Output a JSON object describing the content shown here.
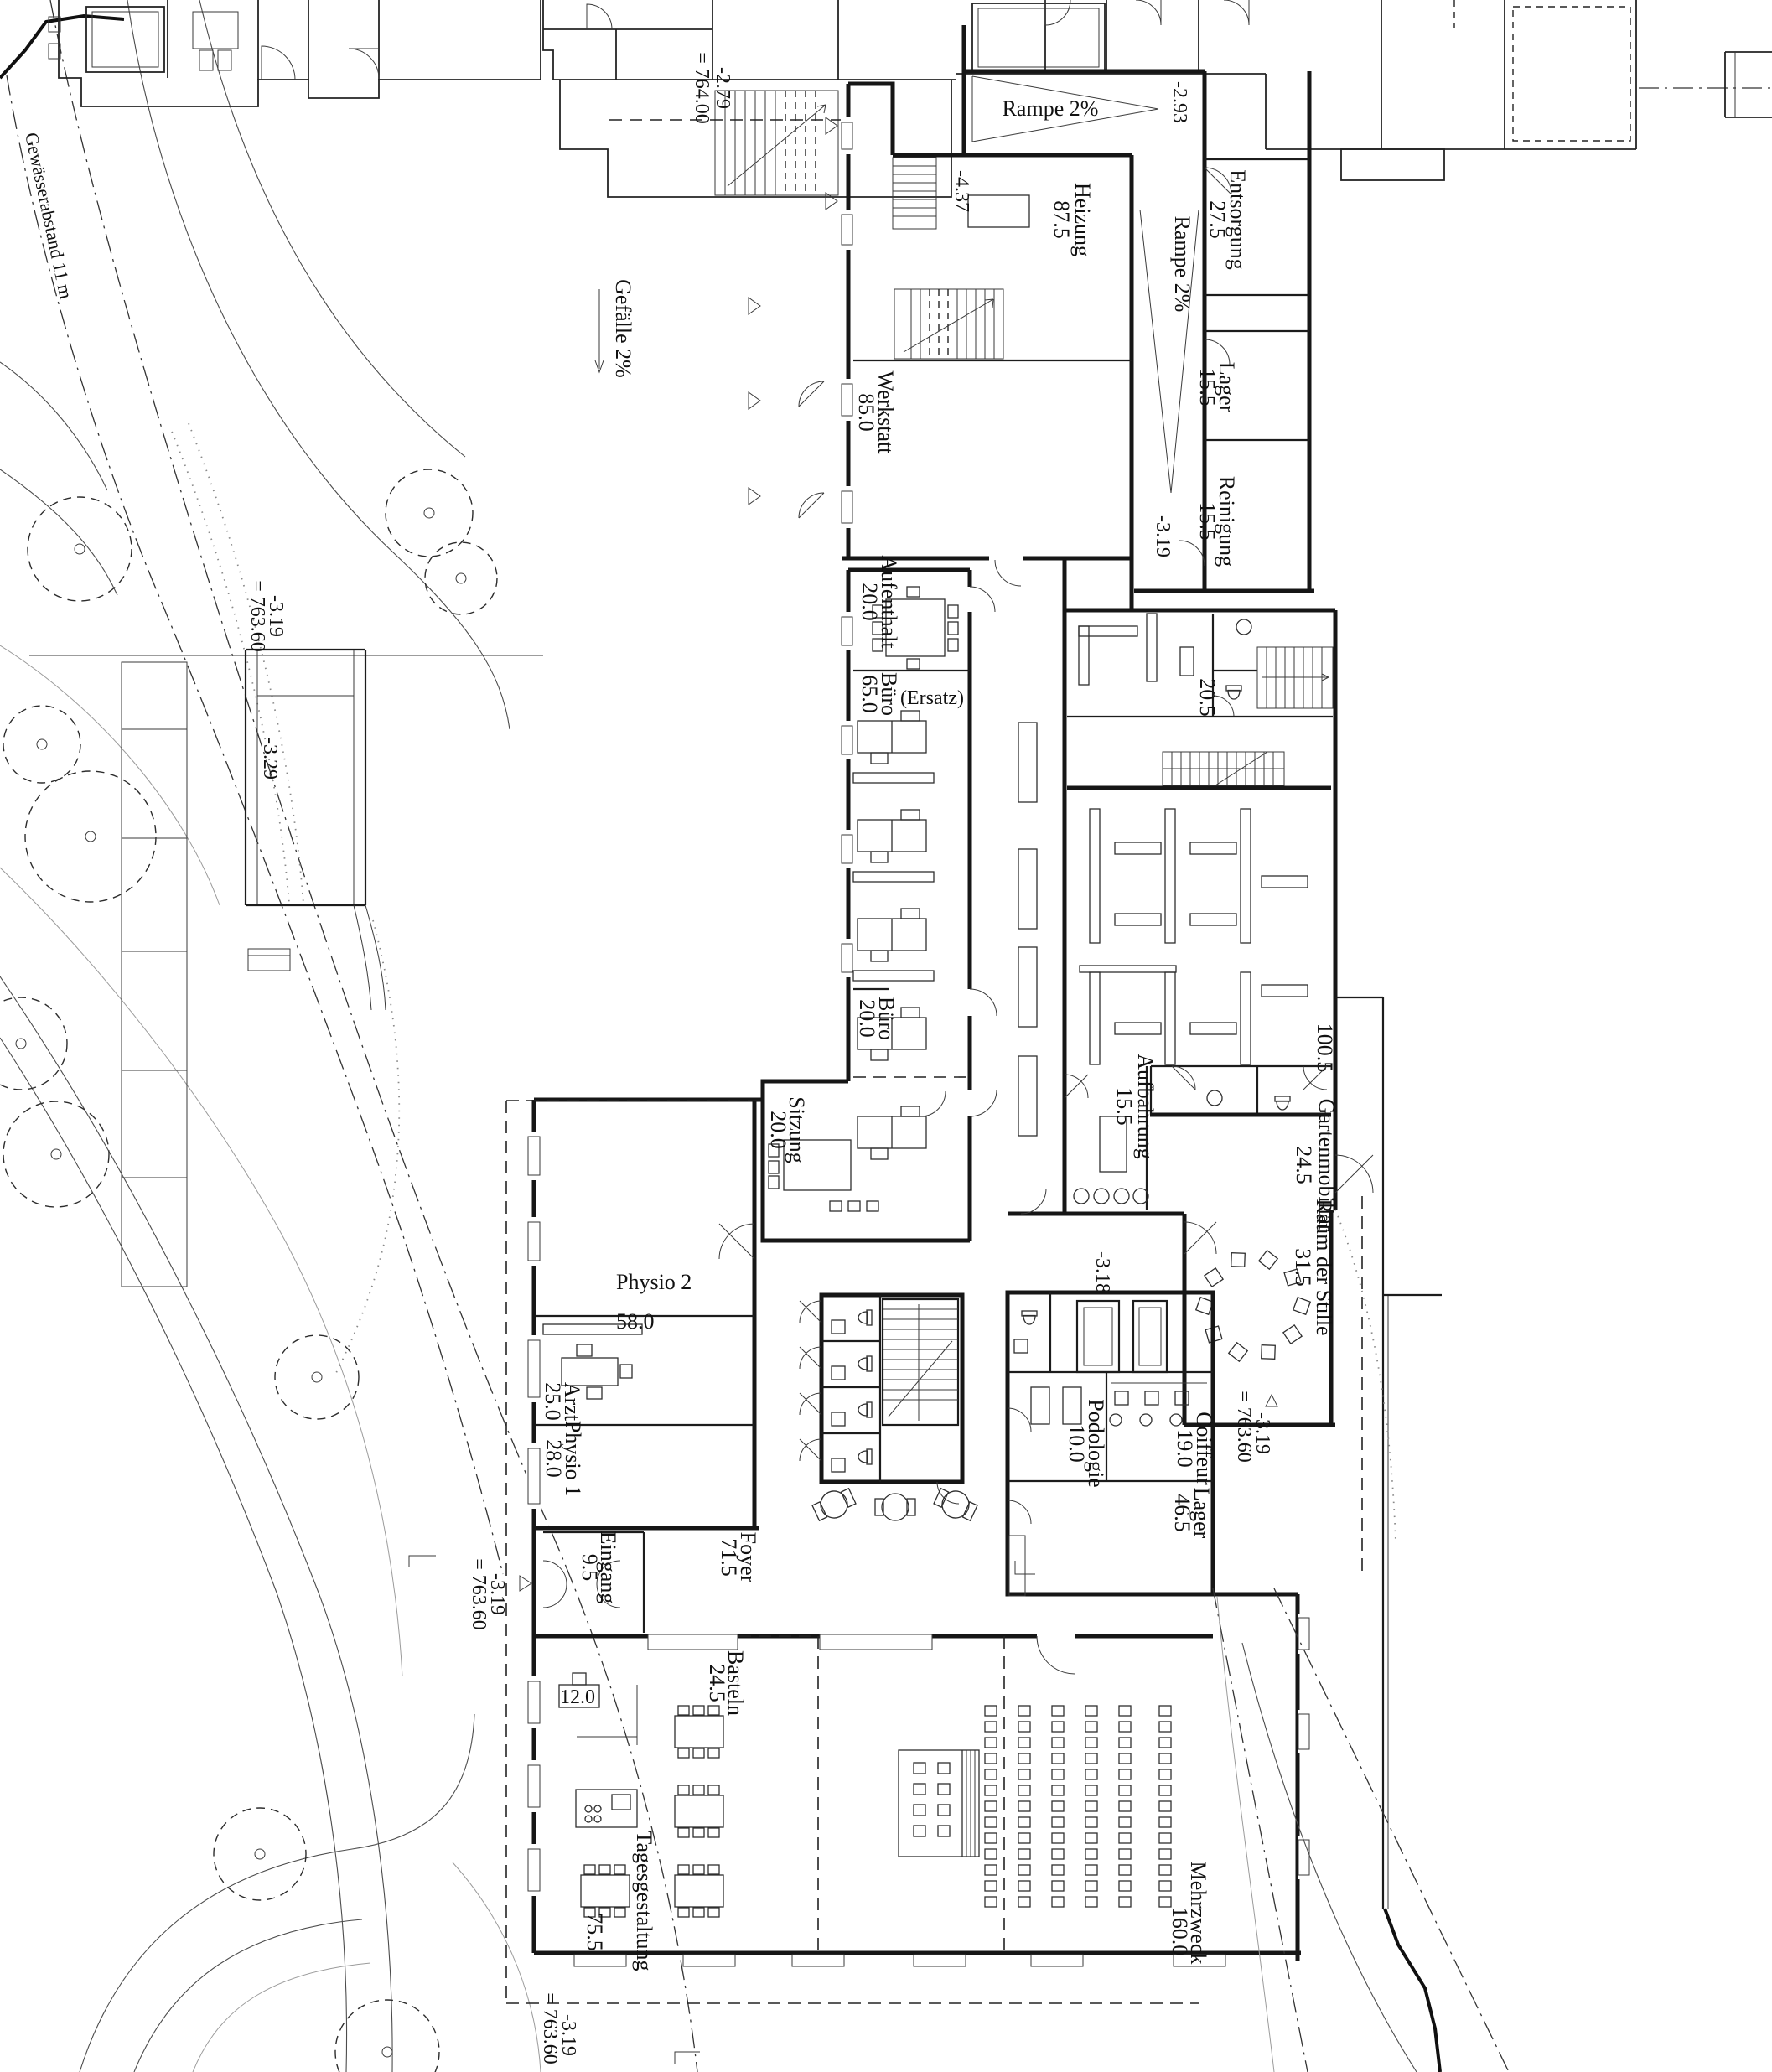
{
  "site": {
    "gewaesserabstand": "Gewässerabstand 11 m",
    "gefaelle": "Gefälle 2%"
  },
  "levels": {
    "l279": "-2.79",
    "l279eq": "= 764.00",
    "l293": "-2.93",
    "l437": "-4.37",
    "l319a": "-3.19",
    "l318": "-3.18",
    "l329": "-3.29",
    "bridge319": "-3.19",
    "bridge319eq": "= 763.60",
    "entr319": "-3.19",
    "entr319eq": "= 763.60",
    "terr319": "-3.19",
    "terr319eq": "= 763.60",
    "bottom319": "-3.19",
    "bottom319eq": "= 763.60"
  },
  "rooms": {
    "rampe_top": "Rampe 2%",
    "rampe_side": "Rampe 2%",
    "heizung": {
      "name": "Heizung",
      "area": "87.5"
    },
    "entsorgung": {
      "name": "Entsorgung",
      "area": "27.5"
    },
    "werkstatt": {
      "name": "Werkstatt",
      "area": "85.0"
    },
    "lager_nord": {
      "name": "Lager",
      "area": "15.5"
    },
    "reinigung": {
      "name": "Reinigung",
      "area": "15.5"
    },
    "aufenthalt": {
      "name": "Aufenthalt",
      "area": "20.0"
    },
    "buero65": {
      "name": "Büro",
      "area": "65.0",
      "note": "(Ersatz)"
    },
    "buero20": {
      "name": "Büro",
      "area": "20.0"
    },
    "raum205": {
      "area": "20.5"
    },
    "lager1005": {
      "area": "100.5"
    },
    "sitzung": {
      "name": "Sitzung",
      "area": "20.0"
    },
    "aufbahrung": {
      "name": "Aufbahrung",
      "area": "15.5"
    },
    "gartenmobiliar": {
      "name": "Gartenmobiliar",
      "area": "24.5"
    },
    "raum_der_stille": {
      "name": "Raum der Stille",
      "area": "31.5"
    },
    "physio2": {
      "name": "Physio 2",
      "area": "58.0"
    },
    "arzt": {
      "name": "Arzt",
      "area": "25.0"
    },
    "physio1": {
      "name": "Physio 1",
      "area": "28.0"
    },
    "eingang": {
      "name": "Eingang",
      "area": "9.5"
    },
    "foyer": {
      "name": "Foyer",
      "area": "71.5"
    },
    "podologie": {
      "name": "Podologie",
      "area": "10.0"
    },
    "coiffeur": {
      "name": "Coiffeur",
      "area": "19.0"
    },
    "lager46": {
      "name": "Lager",
      "area": "46.5"
    },
    "basteln": {
      "name": "Basteln",
      "area": "24.5"
    },
    "kueche": {
      "area": "12.0"
    },
    "tagesgestaltung": {
      "name": "Tagesgestaltung",
      "area": "75.5"
    },
    "mehrzweck": {
      "name": "Mehrzweck",
      "area": "160.0"
    }
  }
}
